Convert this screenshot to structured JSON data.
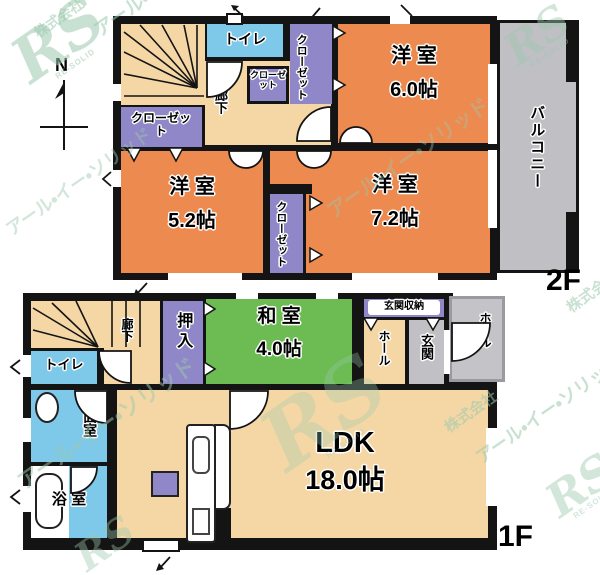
{
  "compass": {
    "north_label": "N"
  },
  "watermark": {
    "company": "株式会社",
    "brand": "アール・イー・ソリッド",
    "logo": "RS",
    "logo_sub": "RE-SOLID"
  },
  "colors": {
    "wall": "#141414",
    "western_room_orange": "#ed8a4f",
    "corridor_beige": "#f5d7a6",
    "wet_area_blue": "#7ec9ea",
    "closet_purple": "#8f87c8",
    "tatami_green": "#6cbc53",
    "balcony_gray": "#bfbfc4",
    "watermark_green": "#9cc9ae"
  },
  "floor2": {
    "floor_label": "2F",
    "toilet": "トイレ",
    "hallway": "廊下",
    "closet_north": "クローゼット",
    "closet_small": "クローゼット",
    "closet_west": "クローゼット",
    "closet_east": "クローゼット",
    "room_ne_name": "洋 室",
    "room_ne_size": "6.0帖",
    "room_sw_name": "洋 室",
    "room_sw_size": "5.2帖",
    "room_se_name": "洋 室",
    "room_se_size": "7.2帖",
    "balcony": "バルコニー"
  },
  "floor1": {
    "floor_label": "1F",
    "toilet": "トイレ",
    "hallway": "廊下",
    "oshiire": "押入",
    "washitsu_name": "和 室",
    "washitsu_size": "4.0帖",
    "entrance_storage": "玄関収納",
    "hall_inner": "ホール",
    "entrance": "玄関",
    "hall_entry": "ホール",
    "washroom": "洗面室",
    "bathroom": "浴 室",
    "ldk_name": "LDK",
    "ldk_size": "18.0帖"
  }
}
